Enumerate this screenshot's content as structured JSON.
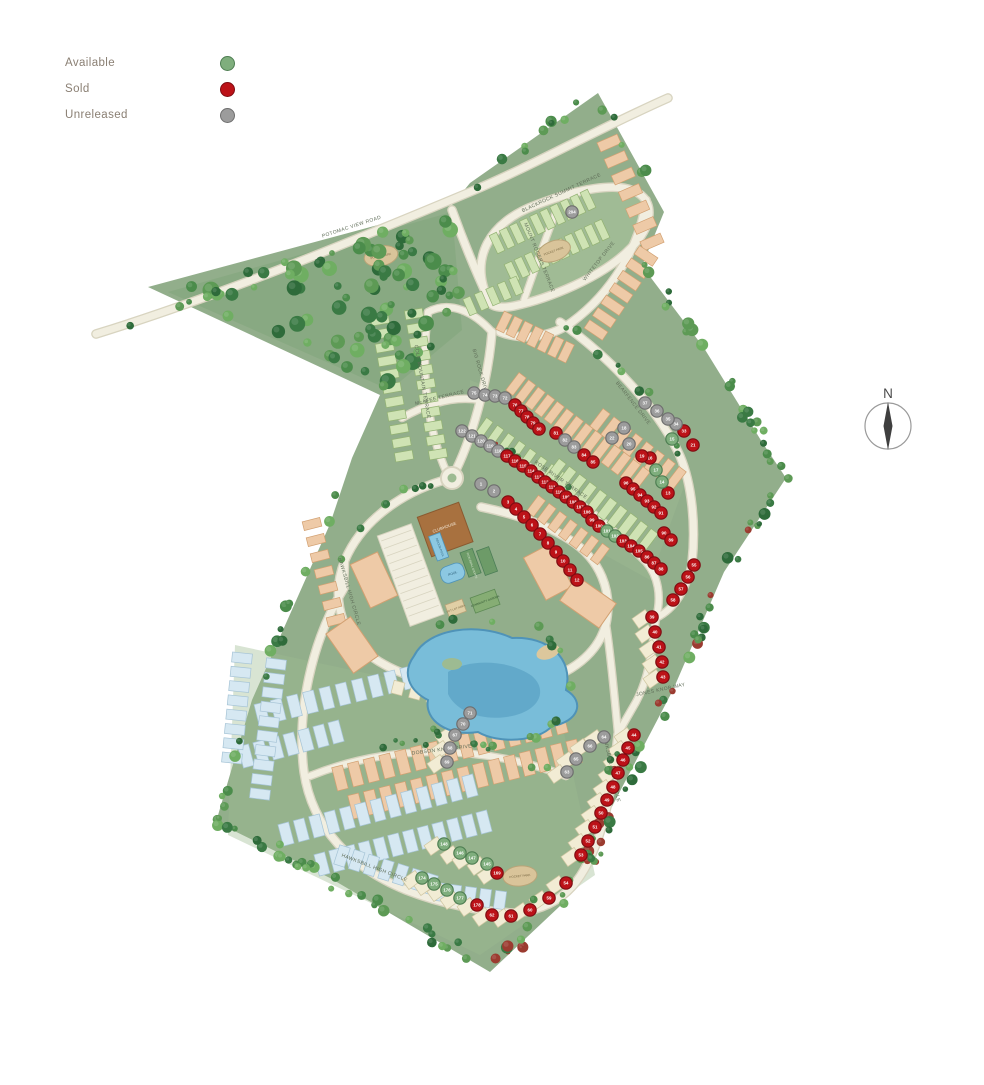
{
  "legend": {
    "items": [
      {
        "label": "Available",
        "status": "available",
        "color": "#7fae7d"
      },
      {
        "label": "Sold",
        "status": "sold",
        "color": "#bc1218"
      },
      {
        "label": "Unreleased",
        "status": "unreleased",
        "color": "#9c9c9c"
      }
    ]
  },
  "compass": {
    "label": "N"
  },
  "map": {
    "palette": {
      "site": "#92ae8b",
      "siteLight": "#9dbb92",
      "ovalInner": "#a6c19a",
      "forest": "#87a881",
      "road": "#f1eee0",
      "roadEdge": "#d8d4c0",
      "pond": "#79bdd9",
      "pondDeep": "#5ba3c4",
      "pondEdge": "#4f93b8",
      "beach": "#dcc79c",
      "clubhouse": "#a8713f",
      "clubhouseEdge": "#8a5a30",
      "houseGreen": "#cfe3b4",
      "houseGreenEdge": "#93b273",
      "houseSalmon": "#eecaa7",
      "houseSalmonEdge": "#d2a071",
      "houseBlue": "#d6e8f2",
      "houseBlueEdge": "#a6c4d6",
      "houseCream": "#f2ecd4",
      "houseCreamEdge": "#cfc6a0",
      "parkFill": "#d9c49a",
      "parkEdge": "#b9a478",
      "court": "#6d9b68",
      "garden": "#86ad74",
      "totlot": "#e0cfa5",
      "streetText": "#5f6d58",
      "treeRed": "#9b3b30"
    },
    "statuses": {
      "a": {
        "label": "Available",
        "fill": "#7fae7d",
        "edge": "#4e7e52"
      },
      "s": {
        "label": "Sold",
        "fill": "#bc1218",
        "edge": "#7e0c12"
      },
      "u": {
        "label": "Unreleased",
        "fill": "#9c9c9c",
        "edge": "#6e6e6e"
      }
    },
    "streets": [
      {
        "name": "POTOMAC VIEW ROAD",
        "x": 352,
        "y": 228,
        "rot": -18
      },
      {
        "name": "BLACKROCK SUMMIT TERRACE",
        "x": 562,
        "y": 194,
        "rot": -25
      },
      {
        "name": "MOUNT ROGERS TERRACE",
        "x": 538,
        "y": 258,
        "rot": 68
      },
      {
        "name": "WHITETOP DRIVE",
        "x": 600,
        "y": 262,
        "rot": -52
      },
      {
        "name": "BIG ROCK DRIVE",
        "x": 479,
        "y": 372,
        "rot": 74
      },
      {
        "name": "COLE MOUNTAIN TERRACE",
        "x": 421,
        "y": 382,
        "rot": 80
      },
      {
        "name": "McAFEE TERRACE",
        "x": 440,
        "y": 399,
        "rot": -14
      },
      {
        "name": "ROSE RIVER TERRACE",
        "x": 560,
        "y": 481,
        "rot": 35
      },
      {
        "name": "BEARFENCE DRIVE",
        "x": 632,
        "y": 404,
        "rot": 52
      },
      {
        "name": "HAWKSBILL HIGH CIRCLE",
        "x": 348,
        "y": 592,
        "rot": 74
      },
      {
        "name": "HAWKSBILL HIGH CIRCLE",
        "x": 610,
        "y": 768,
        "rot": 78
      },
      {
        "name": "HAWKSBILL HIGH CIRCLE",
        "x": 374,
        "y": 869,
        "rot": 21
      },
      {
        "name": "DOBSON KNOB DRIVE",
        "x": 442,
        "y": 751,
        "rot": -7
      },
      {
        "name": "JONES KNOB WAY",
        "x": 661,
        "y": 691,
        "rot": -12
      }
    ],
    "amenities": {
      "clubhouse": "CLUBHOUSE",
      "indoor_pool": "INDOOR POOL",
      "pool": "POOL",
      "courts": "PICKLEBALL COURTS",
      "tot_lot": "TOT LOT AREA",
      "garden": "COMMUNITY GARDEN"
    },
    "pocket_parks": [
      {
        "label": "POCKET PARK",
        "x": 381,
        "y": 256,
        "rot": -12
      },
      {
        "label": "POCKET PARK",
        "x": 554,
        "y": 251,
        "rot": -20
      },
      {
        "label": "POCKET PARK",
        "x": 520,
        "y": 876,
        "rot": -6
      }
    ],
    "lots": [
      {
        "n": "204",
        "s": "u",
        "x": 572,
        "y": 212
      },
      {
        "n": "75",
        "s": "u",
        "x": 474,
        "y": 393
      },
      {
        "n": "74",
        "s": "u",
        "x": 485,
        "y": 395
      },
      {
        "n": "73",
        "s": "u",
        "x": 495,
        "y": 396
      },
      {
        "n": "72",
        "s": "u",
        "x": 505,
        "y": 398
      },
      {
        "n": "76",
        "s": "s",
        "x": 515,
        "y": 405
      },
      {
        "n": "77",
        "s": "s",
        "x": 521,
        "y": 411
      },
      {
        "n": "78",
        "s": "s",
        "x": 527,
        "y": 417
      },
      {
        "n": "79",
        "s": "s",
        "x": 533,
        "y": 423
      },
      {
        "n": "80",
        "s": "s",
        "x": 539,
        "y": 429
      },
      {
        "n": "81",
        "s": "s",
        "x": 556,
        "y": 433
      },
      {
        "n": "82",
        "s": "u",
        "x": 565,
        "y": 440
      },
      {
        "n": "83",
        "s": "u",
        "x": 574,
        "y": 447
      },
      {
        "n": "84",
        "s": "s",
        "x": 584,
        "y": 455
      },
      {
        "n": "85",
        "s": "s",
        "x": 593,
        "y": 462
      },
      {
        "n": "122",
        "s": "u",
        "x": 462,
        "y": 431
      },
      {
        "n": "121",
        "s": "u",
        "x": 472,
        "y": 436
      },
      {
        "n": "120",
        "s": "u",
        "x": 481,
        "y": 441
      },
      {
        "n": "119",
        "s": "u",
        "x": 490,
        "y": 446
      },
      {
        "n": "118",
        "s": "u",
        "x": 498,
        "y": 451
      },
      {
        "n": "117",
        "s": "s",
        "x": 507,
        "y": 456
      },
      {
        "n": "116",
        "s": "s",
        "x": 515,
        "y": 461
      },
      {
        "n": "115",
        "s": "s",
        "x": 523,
        "y": 466
      },
      {
        "n": "114",
        "s": "s",
        "x": 531,
        "y": 471
      },
      {
        "n": "113",
        "s": "s",
        "x": 538,
        "y": 477
      },
      {
        "n": "112",
        "s": "s",
        "x": 545,
        "y": 482
      },
      {
        "n": "111",
        "s": "s",
        "x": 552,
        "y": 487
      },
      {
        "n": "110",
        "s": "s",
        "x": 559,
        "y": 492
      },
      {
        "n": "109",
        "s": "s",
        "x": 566,
        "y": 497
      },
      {
        "n": "108",
        "s": "s",
        "x": 573,
        "y": 502
      },
      {
        "n": "107",
        "s": "s",
        "x": 580,
        "y": 507
      },
      {
        "n": "106",
        "s": "s",
        "x": 587,
        "y": 512
      },
      {
        "n": "1",
        "s": "u",
        "x": 481,
        "y": 484
      },
      {
        "n": "2",
        "s": "u",
        "x": 494,
        "y": 491
      },
      {
        "n": "3",
        "s": "s",
        "x": 508,
        "y": 502
      },
      {
        "n": "4",
        "s": "s",
        "x": 516,
        "y": 509
      },
      {
        "n": "5",
        "s": "s",
        "x": 524,
        "y": 517
      },
      {
        "n": "6",
        "s": "s",
        "x": 532,
        "y": 525
      },
      {
        "n": "7",
        "s": "s",
        "x": 540,
        "y": 534
      },
      {
        "n": "8",
        "s": "s",
        "x": 548,
        "y": 543
      },
      {
        "n": "9",
        "s": "s",
        "x": 556,
        "y": 552
      },
      {
        "n": "10",
        "s": "s",
        "x": 563,
        "y": 561
      },
      {
        "n": "11",
        "s": "s",
        "x": 570,
        "y": 570
      },
      {
        "n": "12",
        "s": "s",
        "x": 577,
        "y": 580
      },
      {
        "n": "99",
        "s": "s",
        "x": 592,
        "y": 520
      },
      {
        "n": "100",
        "s": "s",
        "x": 599,
        "y": 526
      },
      {
        "n": "101",
        "s": "a",
        "x": 607,
        "y": 531
      },
      {
        "n": "102",
        "s": "a",
        "x": 615,
        "y": 536
      },
      {
        "n": "103",
        "s": "s",
        "x": 623,
        "y": 541
      },
      {
        "n": "104",
        "s": "s",
        "x": 631,
        "y": 546
      },
      {
        "n": "105",
        "s": "s",
        "x": 639,
        "y": 551
      },
      {
        "n": "96",
        "s": "s",
        "x": 626,
        "y": 483
      },
      {
        "n": "95",
        "s": "s",
        "x": 633,
        "y": 489
      },
      {
        "n": "94",
        "s": "s",
        "x": 640,
        "y": 495
      },
      {
        "n": "93",
        "s": "s",
        "x": 647,
        "y": 501
      },
      {
        "n": "92",
        "s": "s",
        "x": 654,
        "y": 507
      },
      {
        "n": "91",
        "s": "s",
        "x": 661,
        "y": 513
      },
      {
        "n": "90",
        "s": "s",
        "x": 664,
        "y": 533
      },
      {
        "n": "89",
        "s": "s",
        "x": 671,
        "y": 540
      },
      {
        "n": "86",
        "s": "s",
        "x": 647,
        "y": 557
      },
      {
        "n": "87",
        "s": "s",
        "x": 654,
        "y": 563
      },
      {
        "n": "88",
        "s": "s",
        "x": 661,
        "y": 569
      },
      {
        "n": "13",
        "s": "s",
        "x": 668,
        "y": 493
      },
      {
        "n": "14",
        "s": "a",
        "x": 662,
        "y": 482
      },
      {
        "n": "15",
        "s": "a",
        "x": 672,
        "y": 439
      },
      {
        "n": "16",
        "s": "s",
        "x": 650,
        "y": 458
      },
      {
        "n": "17",
        "s": "a",
        "x": 656,
        "y": 470
      },
      {
        "n": "18",
        "s": "u",
        "x": 624,
        "y": 428
      },
      {
        "n": "19",
        "s": "s",
        "x": 642,
        "y": 456
      },
      {
        "n": "20",
        "s": "u",
        "x": 629,
        "y": 444
      },
      {
        "n": "21",
        "s": "s",
        "x": 693,
        "y": 445
      },
      {
        "n": "22",
        "s": "u",
        "x": 612,
        "y": 438
      },
      {
        "n": "33",
        "s": "s",
        "x": 684,
        "y": 431
      },
      {
        "n": "34",
        "s": "u",
        "x": 676,
        "y": 424
      },
      {
        "n": "35",
        "s": "u",
        "x": 668,
        "y": 419
      },
      {
        "n": "36",
        "s": "u",
        "x": 657,
        "y": 411
      },
      {
        "n": "37",
        "s": "u",
        "x": 645,
        "y": 403
      },
      {
        "n": "55",
        "s": "s",
        "x": 694,
        "y": 565
      },
      {
        "n": "56",
        "s": "s",
        "x": 688,
        "y": 577
      },
      {
        "n": "57",
        "s": "s",
        "x": 681,
        "y": 589
      },
      {
        "n": "58",
        "s": "s",
        "x": 673,
        "y": 600
      },
      {
        "n": "39",
        "s": "s",
        "x": 652,
        "y": 617
      },
      {
        "n": "40",
        "s": "s",
        "x": 655,
        "y": 632
      },
      {
        "n": "41",
        "s": "s",
        "x": 659,
        "y": 647
      },
      {
        "n": "42",
        "s": "s",
        "x": 662,
        "y": 662
      },
      {
        "n": "43",
        "s": "s",
        "x": 663,
        "y": 677
      },
      {
        "n": "44",
        "s": "s",
        "x": 634,
        "y": 735
      },
      {
        "n": "45",
        "s": "s",
        "x": 628,
        "y": 748
      },
      {
        "n": "46",
        "s": "s",
        "x": 623,
        "y": 760
      },
      {
        "n": "47",
        "s": "s",
        "x": 618,
        "y": 773
      },
      {
        "n": "64",
        "s": "u",
        "x": 604,
        "y": 737
      },
      {
        "n": "66",
        "s": "u",
        "x": 590,
        "y": 746
      },
      {
        "n": "65",
        "s": "u",
        "x": 576,
        "y": 759
      },
      {
        "n": "63",
        "s": "u",
        "x": 567,
        "y": 772
      },
      {
        "n": "48",
        "s": "s",
        "x": 613,
        "y": 787
      },
      {
        "n": "49",
        "s": "s",
        "x": 607,
        "y": 800
      },
      {
        "n": "50",
        "s": "s",
        "x": 601,
        "y": 813
      },
      {
        "n": "51",
        "s": "s",
        "x": 595,
        "y": 827
      },
      {
        "n": "52",
        "s": "s",
        "x": 588,
        "y": 841
      },
      {
        "n": "53",
        "s": "s",
        "x": 581,
        "y": 855
      },
      {
        "n": "54",
        "s": "s",
        "x": 566,
        "y": 883
      },
      {
        "n": "59",
        "s": "s",
        "x": 549,
        "y": 898
      },
      {
        "n": "60",
        "s": "s",
        "x": 530,
        "y": 910
      },
      {
        "n": "61",
        "s": "s",
        "x": 511,
        "y": 916
      },
      {
        "n": "62",
        "s": "s",
        "x": 492,
        "y": 915
      },
      {
        "n": "71",
        "s": "u",
        "x": 470,
        "y": 713
      },
      {
        "n": "70",
        "s": "u",
        "x": 463,
        "y": 724
      },
      {
        "n": "67",
        "s": "u",
        "x": 455,
        "y": 735
      },
      {
        "n": "68",
        "s": "u",
        "x": 450,
        "y": 748
      },
      {
        "n": "69",
        "s": "u",
        "x": 447,
        "y": 762
      },
      {
        "n": "148",
        "s": "a",
        "x": 444,
        "y": 844
      },
      {
        "n": "146",
        "s": "a",
        "x": 460,
        "y": 853
      },
      {
        "n": "147",
        "s": "a",
        "x": 472,
        "y": 858
      },
      {
        "n": "145",
        "s": "a",
        "x": 487,
        "y": 864
      },
      {
        "n": "169",
        "s": "s",
        "x": 497,
        "y": 873
      },
      {
        "n": "174",
        "s": "a",
        "x": 422,
        "y": 878
      },
      {
        "n": "175",
        "s": "a",
        "x": 434,
        "y": 884
      },
      {
        "n": "176",
        "s": "a",
        "x": 447,
        "y": 890
      },
      {
        "n": "177",
        "s": "a",
        "x": 460,
        "y": 898
      },
      {
        "n": "178",
        "s": "s",
        "x": 477,
        "y": 905
      }
    ]
  }
}
